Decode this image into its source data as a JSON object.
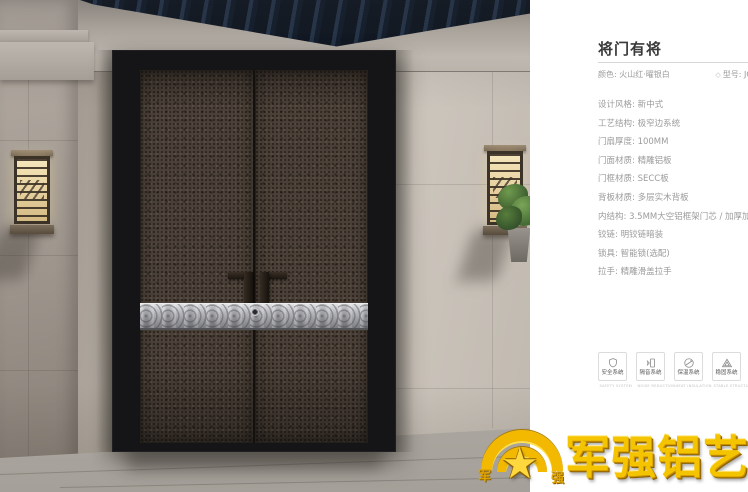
{
  "panel": {
    "title": "将门有将",
    "color_label": "颜色: 火山红·曜银白",
    "model_label": "型号: JC",
    "specs": [
      "设计风格: 新中式",
      "工艺结构: 极窄边系统",
      "门扇厚度: 100MM",
      "门面材质: 精雕铝板",
      "门框材质: SECC板",
      "背板材质: 多层实木背板",
      "内结构: 3.5MM大空铝框架门芯 / 加厚加密航空铝蜂窝",
      "铰链: 明铰链暗装",
      "锁具: 智能锁(选配)",
      "拉手: 精雕滑盖拉手"
    ],
    "features": [
      {
        "label": "安全系统",
        "caption": "SAFETY SYSTEM"
      },
      {
        "label": "隔音系统",
        "caption": "NOISE REDUCTION"
      },
      {
        "label": "保温系统",
        "caption": "HEAT INSULATION"
      },
      {
        "label": "稳固系统",
        "caption": "STABLE STRUCTURE"
      }
    ]
  },
  "logo": {
    "brand": "军强铝艺",
    "emblem_left": "军",
    "emblem_right": "强"
  },
  "colors": {
    "brand_gold": "#f2b900",
    "spec_text": "#9b9b9b",
    "title_text": "#3a3a3a",
    "door_panel": "#4b4138",
    "silver_band": "#b9babe"
  }
}
